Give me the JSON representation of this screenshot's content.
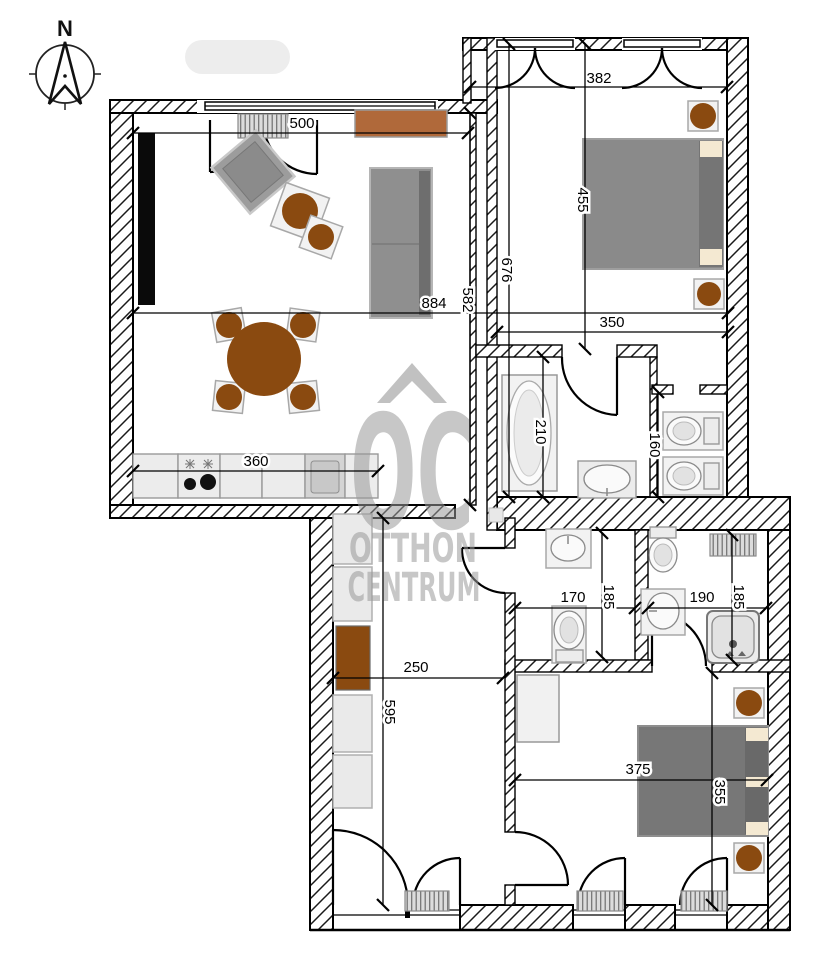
{
  "compass": {
    "label": "N"
  },
  "watermark": {
    "logo": "OC",
    "line1": "OTTHON",
    "line2": "CENTRUM"
  },
  "dimensions": {
    "living_window": "500",
    "living_width": "884",
    "living_depth": "582",
    "kitchen_run": "360",
    "bedroom1_width": "382",
    "bedroom1_depth": "455",
    "wing_depth": "676",
    "bedroom1_inner": "350",
    "bathroom_depth": "210",
    "wc_depth": "160",
    "wc2_width": "170",
    "wc2_depth": "185",
    "shower_width": "190",
    "shower_depth": "185",
    "hall_width": "250",
    "hall_depth": "595",
    "bedroom2_width": "375",
    "bedroom2_depth": "355"
  },
  "colors": {
    "wall_black": "#000000",
    "furniture_brown": "#8a4a10",
    "sideboard_brown": "#b0693a",
    "sofa_gray": "#8f8f8f",
    "bed_gray": "#7d7d7d",
    "pillow_beige": "#f4e9d2",
    "fixture_gray": "#ececec",
    "watermark_gray": "#9a9a9a"
  }
}
